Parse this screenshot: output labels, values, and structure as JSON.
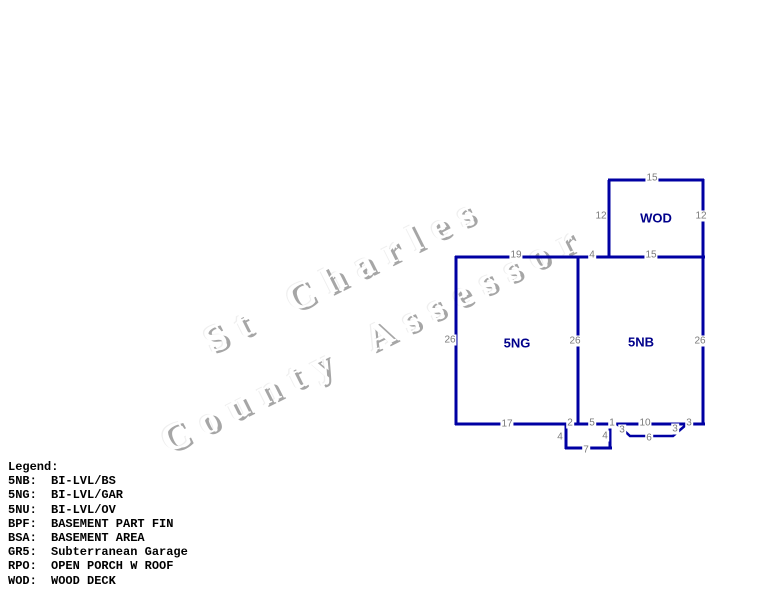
{
  "watermark": {
    "line1": "St Charles",
    "line2": "County Assessor"
  },
  "rooms": {
    "wod": "WOD",
    "left": "5NG",
    "right": "5NB"
  },
  "dims": {
    "wod_top": "15",
    "wod_left": "12",
    "wod_right": "12",
    "top_left": "19",
    "top_mid": "4",
    "top_right": "15",
    "side_left": "26",
    "side_mid": "26",
    "side_right": "26",
    "bottom_17": "17",
    "bottom_2": "2",
    "bottom_5": "5",
    "bottom_1": "1",
    "bottom_10": "10",
    "bottom_3": "3",
    "stoop_left": "4",
    "stoop_right": "4",
    "stoop_bottom": "7",
    "patio_left": "3",
    "patio_bottom": "6",
    "patio_right": "3"
  },
  "colors": {
    "plan_line": "#0000A3",
    "room_label": "#00008B",
    "dim_label": "#7b7b7b",
    "watermark_shadow": "#a6a6a6"
  },
  "legend": {
    "title": "Legend:",
    "entries": [
      {
        "code": "5NB:",
        "desc": "BI-LVL/BS"
      },
      {
        "code": "5NG:",
        "desc": "BI-LVL/GAR"
      },
      {
        "code": "5NU:",
        "desc": "BI-LVL/OV"
      },
      {
        "code": "BPF:",
        "desc": "BASEMENT PART FIN"
      },
      {
        "code": "BSA:",
        "desc": "BASEMENT AREA"
      },
      {
        "code": "GR5:",
        "desc": "Subterranean Garage"
      },
      {
        "code": "RPO:",
        "desc": "OPEN PORCH W ROOF"
      },
      {
        "code": "WOD:",
        "desc": "WOOD DECK"
      }
    ]
  }
}
